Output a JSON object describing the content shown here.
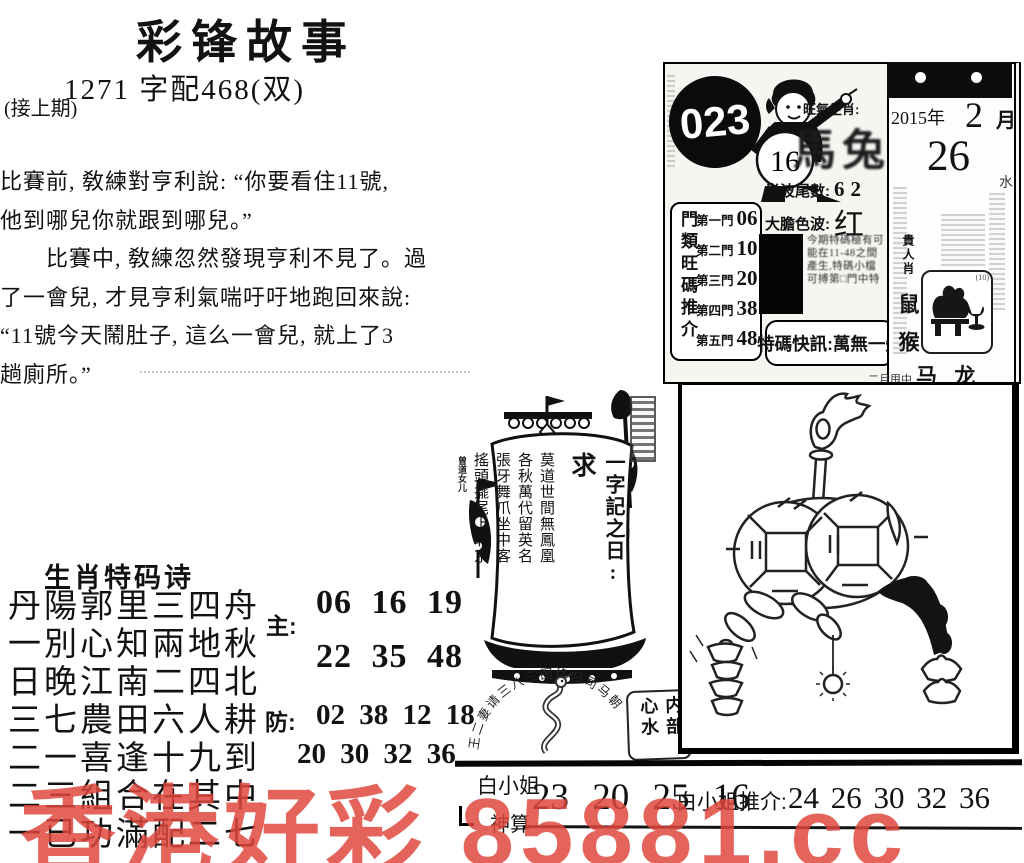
{
  "header": {
    "title": "彩锋故事",
    "subtitle": "1271 字配468(双)",
    "continued_note": "(接上期)"
  },
  "story": {
    "lines": [
      "比賽前, 敎練對亨利說: “你要看住11號,",
      "他到哪兒你就跟到哪兒。”",
      "　　比賽中, 敎練忽然發現亨利不見了。過",
      "了一會兒, 才見亨利氣喘吁吁地跑回來說:",
      "“11號今天鬧肚子, 這么一會兒, 就上了3",
      "趟廁所。”"
    ]
  },
  "zodiac_poem": {
    "title": "生肖特码诗",
    "lines": [
      "丹陽郭里三四舟",
      "一別心知兩地秋",
      "日晚江南二四北",
      "三七農田六人耕",
      "二一喜逢十九到",
      "二三組合在其中",
      "一已功滿配二七"
    ],
    "main_label": "主:",
    "main_rows": [
      "06 16 19",
      "22 35 48"
    ],
    "guard_label": "防:",
    "guard_rows": [
      "02 38 12 18",
      "20 30 32 36"
    ]
  },
  "info_panel": {
    "issue_number": "023",
    "mascot_number": "16",
    "hot_zodiac_label": "旺氣生肖:",
    "hot_zodiac_value": "馬兔",
    "half_wave_label": "半波尾數:",
    "half_wave_value": "62",
    "color_wave_label": "大膽色波:",
    "color_wave_value": "红 绿",
    "gates_vertical_label": "門類旺碼推介",
    "gates": [
      {
        "name": "第一門",
        "number": "06"
      },
      {
        "name": "第二門",
        "number": "10"
      },
      {
        "name": "第三門",
        "number": "20"
      },
      {
        "name": "第四門",
        "number": "38"
      },
      {
        "name": "第五門",
        "number": "48"
      }
    ],
    "notice_text": "今期特碼極有可能在11-48之間產生,特碼小檔可搏第□門中特",
    "special_news": "特碼快訊:萬無一失",
    "noble_label": "貴人肖",
    "noble_animals": [
      "鼠",
      "猴"
    ],
    "stamp_note": "(10)",
    "foot_small": "二月甩中",
    "foot_large": "马 龙",
    "calendar": {
      "year": "2015年",
      "month": "2",
      "month_unit": "月",
      "day": "26",
      "side_char": "水"
    }
  },
  "ship": {
    "riddle_label": "一字記之日:",
    "riddle_answer": "求",
    "sail_poem": [
      "莫道世間無鳳凰",
      "各秋萬代留英名",
      "張牙舞爪坐中客",
      "搖頭擺尾上北京"
    ],
    "signature": "曾道女儿"
  },
  "arc_seal": {
    "arc_text": "王二妻请三八三图终归司马朝"
  },
  "inner_tip_box": {
    "text": "内部心水"
  },
  "bottom_strip": {
    "name_line1": "白小姐",
    "name_line2": "神算",
    "numbers_main": "23 20 25 16",
    "recommend_label": "白小姐推介:",
    "recommend_numbers": "24 26 30 32 36"
  },
  "watermark": {
    "text": "香港好彩 85881.cc",
    "color": "#e0473e"
  }
}
